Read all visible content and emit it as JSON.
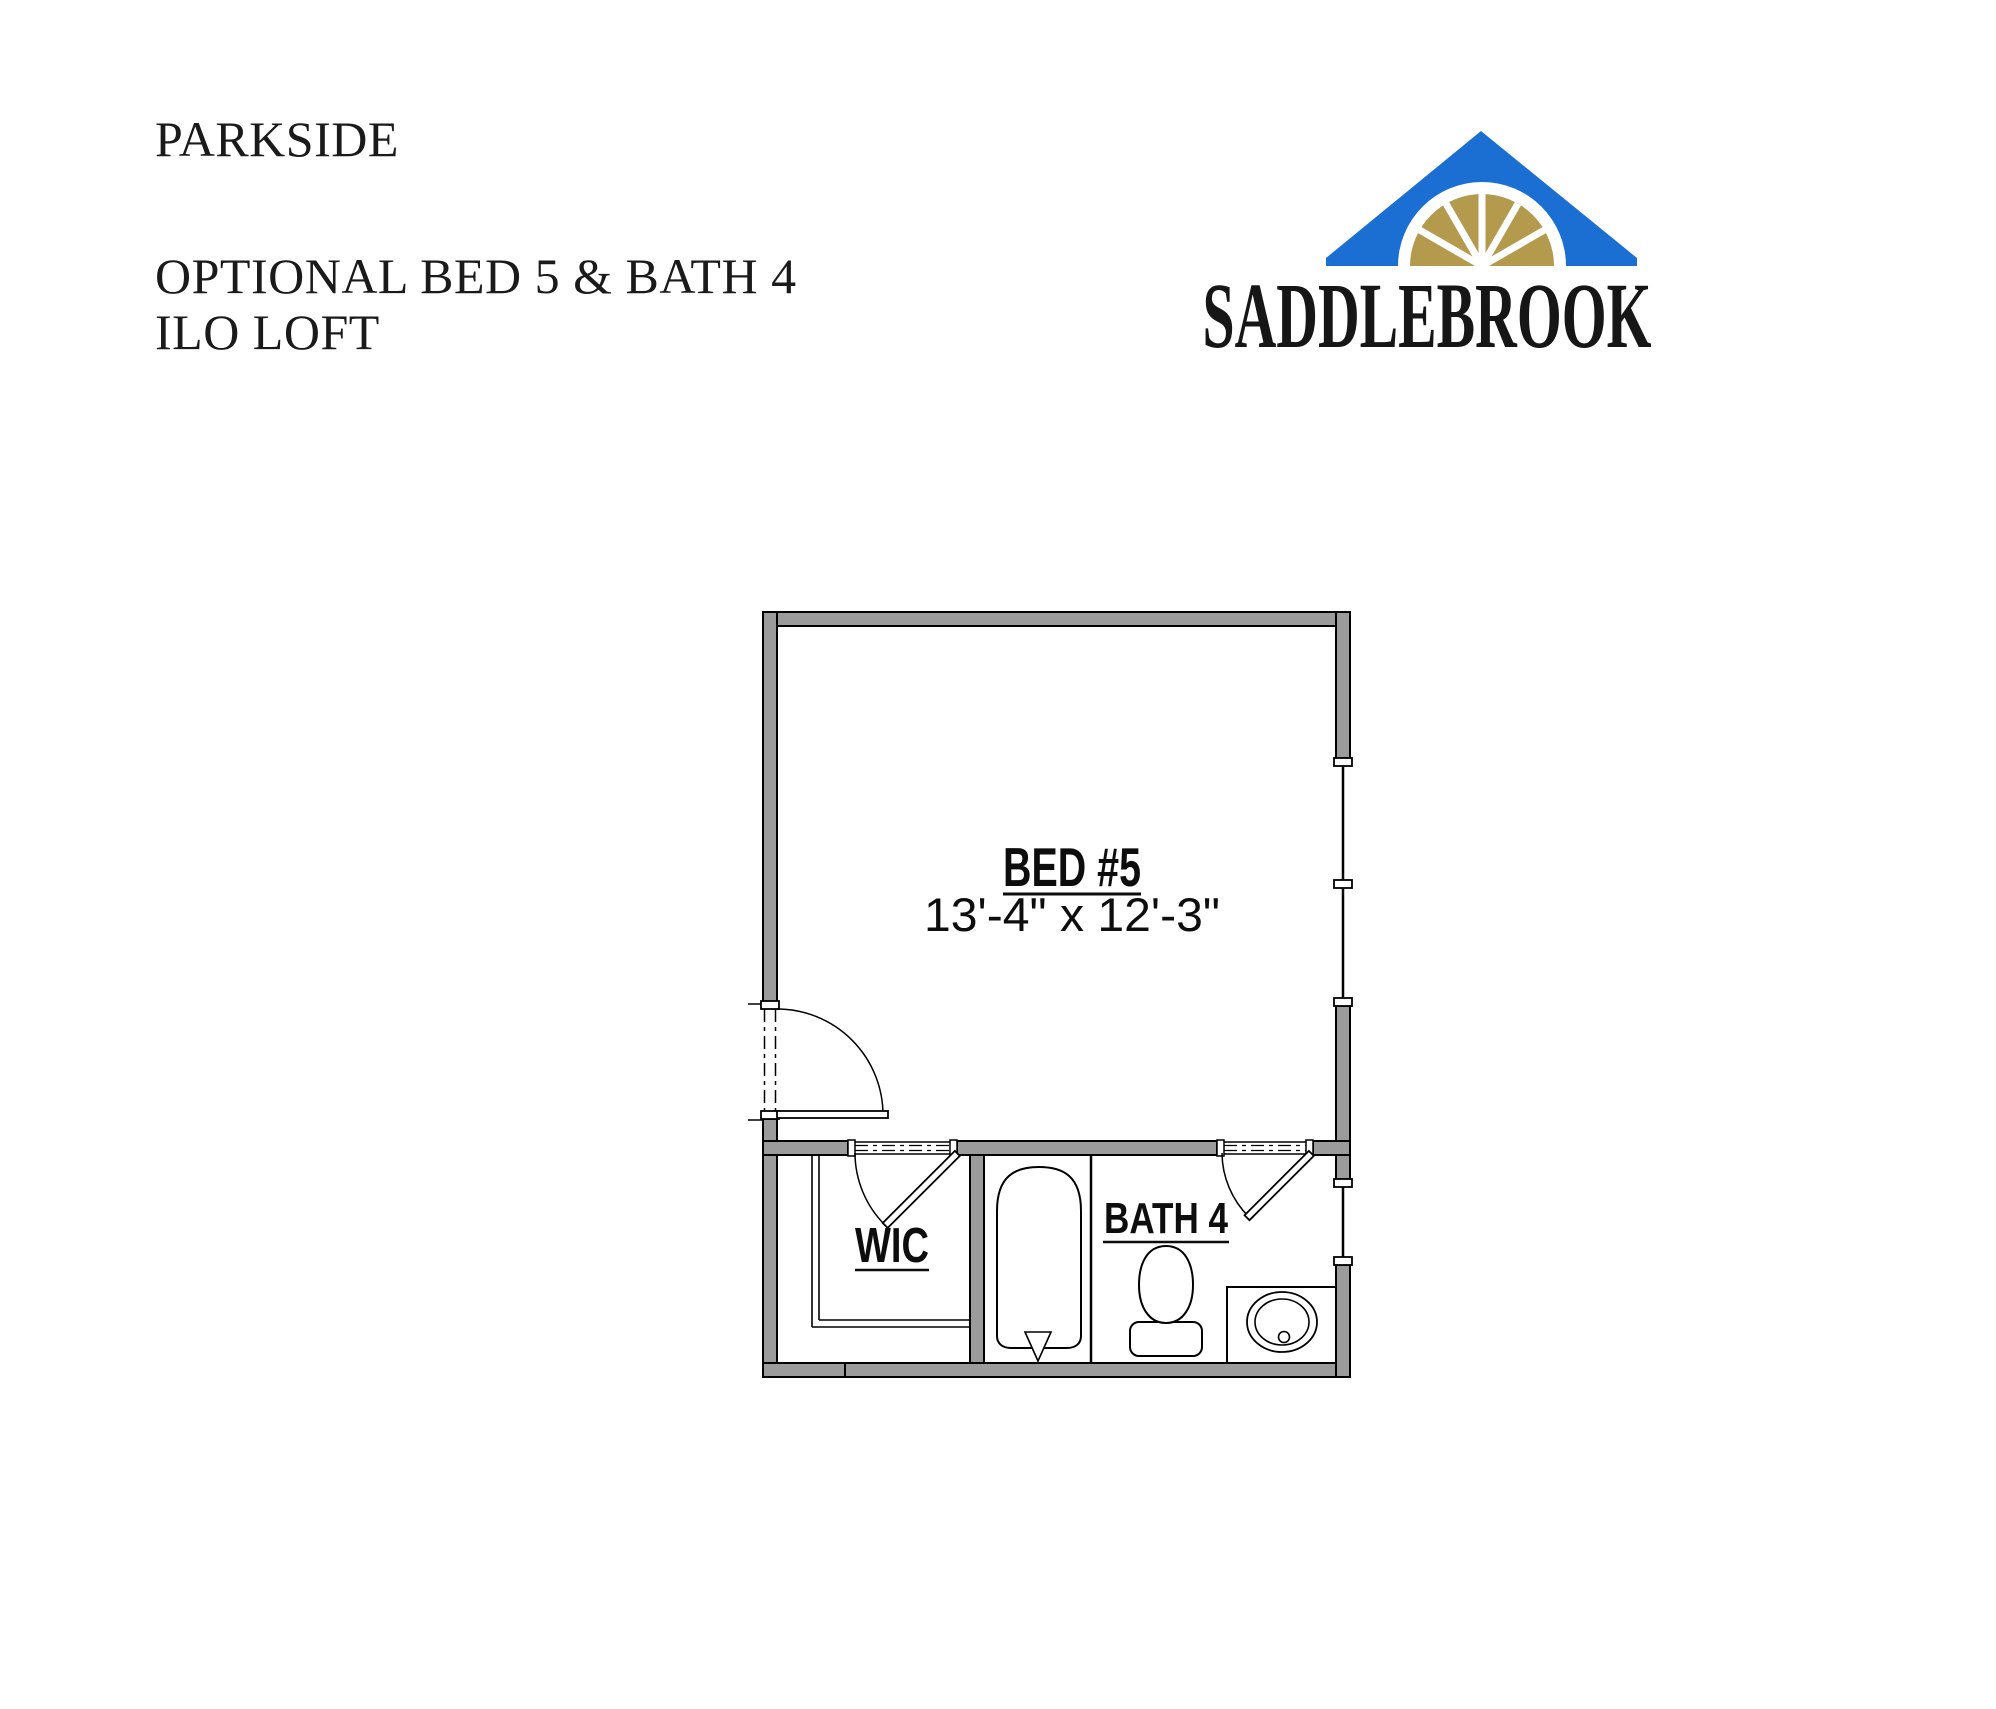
{
  "page": {
    "background": "#ffffff"
  },
  "title_block": {
    "project": "PARKSIDE",
    "option_line1": "OPTIONAL BED 5 & BATH 4",
    "option_line2": "ILO LOFT"
  },
  "logo": {
    "brand": "SADDLEBROOK",
    "roof_color": "#1c6fd2",
    "fan_color": "#b39a4d",
    "text_color": "#161616"
  },
  "floor_plan": {
    "wall_color": "#9b9b9b",
    "line_color": "#000000",
    "bedroom": {
      "label": "BED #5",
      "dimensions": "13'-4\" x 12'-3\""
    },
    "closet": {
      "label": "WIC"
    },
    "bathroom": {
      "label": "BATH 4"
    }
  }
}
